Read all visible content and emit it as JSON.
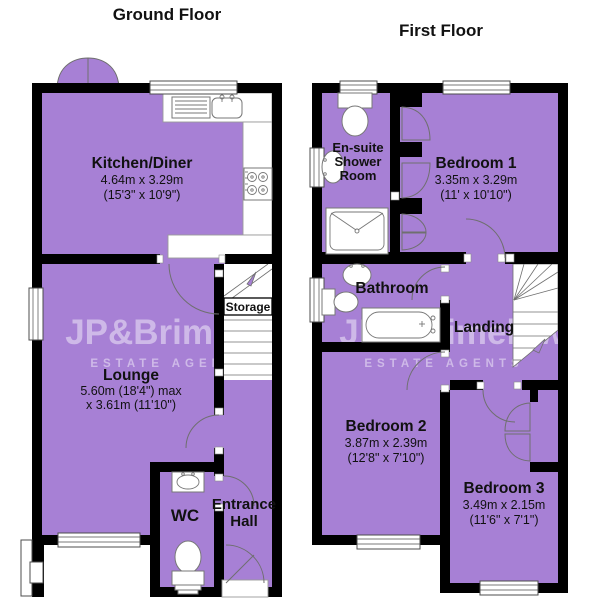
{
  "page": {
    "background": "#ffffff"
  },
  "colors": {
    "room_fill": "#a780d5",
    "wall": "#000000",
    "watermark": "rgba(255,255,255,0.45)",
    "fixture_stroke": "#777777",
    "text": "#111111"
  },
  "watermark": {
    "brand": "JP&Brimelow",
    "tagline": "ESTATE AGENTS"
  },
  "floors": {
    "ground": {
      "title": "Ground Floor",
      "rooms": {
        "kitchen": {
          "name": "Kitchen/Diner",
          "dims_metric": "4.64m x 3.29m",
          "dims_imperial": "(15'3\" x 10'9\")"
        },
        "lounge": {
          "name": "Lounge",
          "dims_metric": "5.60m (18'4\") max",
          "dims_imperial": "x 3.61m (11'10\")"
        },
        "storage": {
          "name": "Storage"
        },
        "wc": {
          "name": "WC"
        },
        "entrance_hall": {
          "name_line1": "Entrance",
          "name_line2": "Hall"
        }
      }
    },
    "first": {
      "title": "First Floor",
      "rooms": {
        "ensuite": {
          "name_line1": "En-suite",
          "name_line2": "Shower",
          "name_line3": "Room"
        },
        "bedroom1": {
          "name": "Bedroom 1",
          "dims_metric": "3.35m x 3.29m",
          "dims_imperial": "(11' x 10'10\")"
        },
        "bathroom": {
          "name": "Bathroom"
        },
        "landing": {
          "name": "Landing"
        },
        "bedroom2": {
          "name": "Bedroom 2",
          "dims_metric": "3.87m x 2.39m",
          "dims_imperial": "(12'8\" x 7'10\")"
        },
        "bedroom3": {
          "name": "Bedroom 3",
          "dims_metric": "3.49m x 2.15m",
          "dims_imperial": "(11'6\" x 7'1\")"
        }
      }
    }
  }
}
